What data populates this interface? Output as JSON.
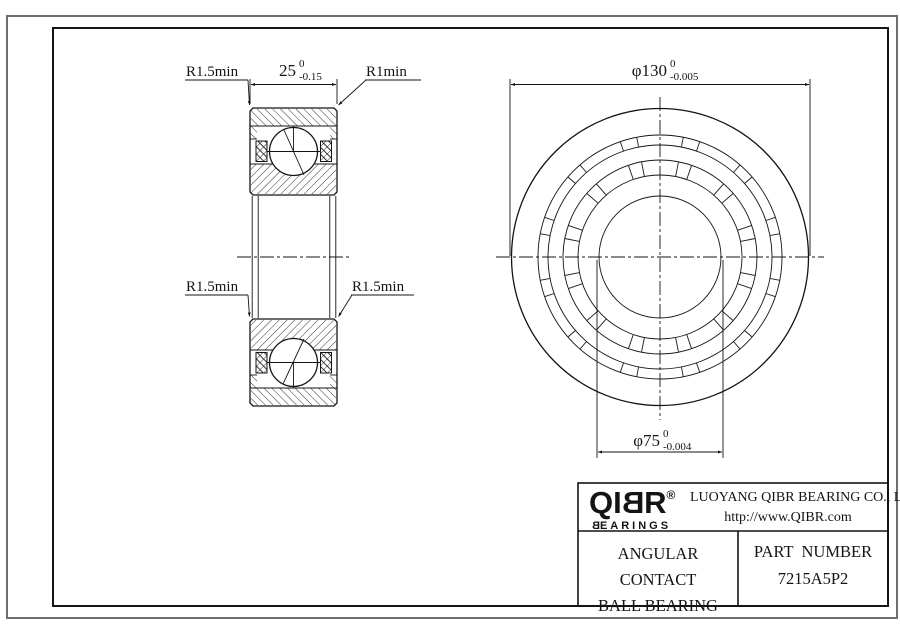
{
  "drawing": {
    "section_view": {
      "width_dim": {
        "value": "25",
        "tol_upper": "0",
        "tol_lower": "-0.15"
      },
      "labels": {
        "top_left": "R1.5min",
        "top_right": "R1min",
        "mid_left": "R1.5min",
        "mid_right": "R1.5min"
      }
    },
    "front_view": {
      "outer_dim": {
        "value": "φ130",
        "tol_upper": "0",
        "tol_lower": "-0.005"
      },
      "bore_dim": {
        "value": "φ75",
        "tol_upper": "0",
        "tol_lower": "-0.004"
      }
    }
  },
  "title_block": {
    "logo": {
      "prefix": "QI",
      "mirrored": "B",
      "suffix": "R",
      "registered": "®",
      "sub_mirrored": "B",
      "sub_rest": "EARINGS"
    },
    "company": "LUOYANG QIBR BEARING CO., LTD",
    "url": "http://www.QIBR.com",
    "part_name_line1": "ANGULAR CONTACT",
    "part_name_line2": "BALL BEARING",
    "part_number_label": "PART  NUMBER",
    "part_number": "7215A5P2"
  },
  "colors": {
    "line": "#141414",
    "outer_border": "#6e6e6e",
    "background": "#ffffff"
  }
}
